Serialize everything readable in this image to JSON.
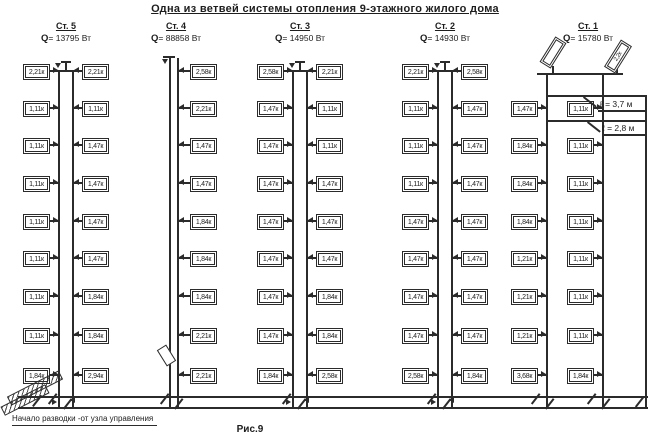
{
  "title": "Одна из ветвей системы отопления 9-этажного жилого дома",
  "caption": "Рис.9",
  "footer_note": "Начало разводки -от узла управления",
  "q_symbol": "Q",
  "callouts": [
    "ℓ = 3,7 м",
    "ℓ = 2,8 м"
  ],
  "risers": [
    {
      "name": "Ст. 5",
      "q_value": "= 13795 Вт",
      "left": [
        "2,21к",
        "1,11к",
        "1,11к",
        "1,11к",
        "1,11к",
        "1,11к",
        "1,11к",
        "1,11к",
        "1,84к"
      ],
      "right": [
        "2,21к",
        "1,11к",
        "1,47к",
        "1,47к",
        "1,47к",
        "1,47к",
        "1,84к",
        "1,84к",
        "2,94к"
      ]
    },
    {
      "name": "Ст. 4",
      "q_value": "= 88858 Вт",
      "left": [],
      "right": [
        "2,58к",
        "2,21к",
        "1,47к",
        "1,47к",
        "1,84к",
        "1,84к",
        "1,84к",
        "2,21к",
        "2,21к"
      ]
    },
    {
      "name": "Ст. 3",
      "q_value": "= 14950 Вт",
      "left": [
        "2,58к",
        "1,47к",
        "1,47к",
        "1,47к",
        "1,47к",
        "1,47к",
        "1,47к",
        "1,47к",
        "1,84к"
      ],
      "right": [
        "2,21к",
        "1,11к",
        "1,11к",
        "1,47к",
        "1,47к",
        "1,47к",
        "1,84к",
        "1,84к",
        "2,58к"
      ]
    },
    {
      "name": "Ст. 2",
      "q_value": "= 14930 Вт",
      "left": [
        "2,21к",
        "1,11к",
        "1,11к",
        "1,11к",
        "1,47к",
        "1,47к",
        "1,47к",
        "1,47к",
        "2,58к"
      ],
      "right": [
        "2,58к",
        "1,47к",
        "1,47к",
        "1,47к",
        "1,47к",
        "1,47к",
        "1,47к",
        "1,47к",
        "1,84к"
      ]
    },
    {
      "name": "Ст. 1",
      "q_value": "= 15780 Вт",
      "left": [
        null,
        "1,47к",
        "1,84к",
        "1,84к",
        "1,84к",
        "1,21к",
        "1,21к",
        "1,21к",
        "3,68к"
      ],
      "right": [
        null,
        "1,11к",
        "1,11к",
        "1,11к",
        "1,11к",
        "1,11к",
        "1,11к",
        "1,11к",
        "1,84к"
      ],
      "slanted_left": "",
      "slanted_right": "2,2к"
    }
  ]
}
